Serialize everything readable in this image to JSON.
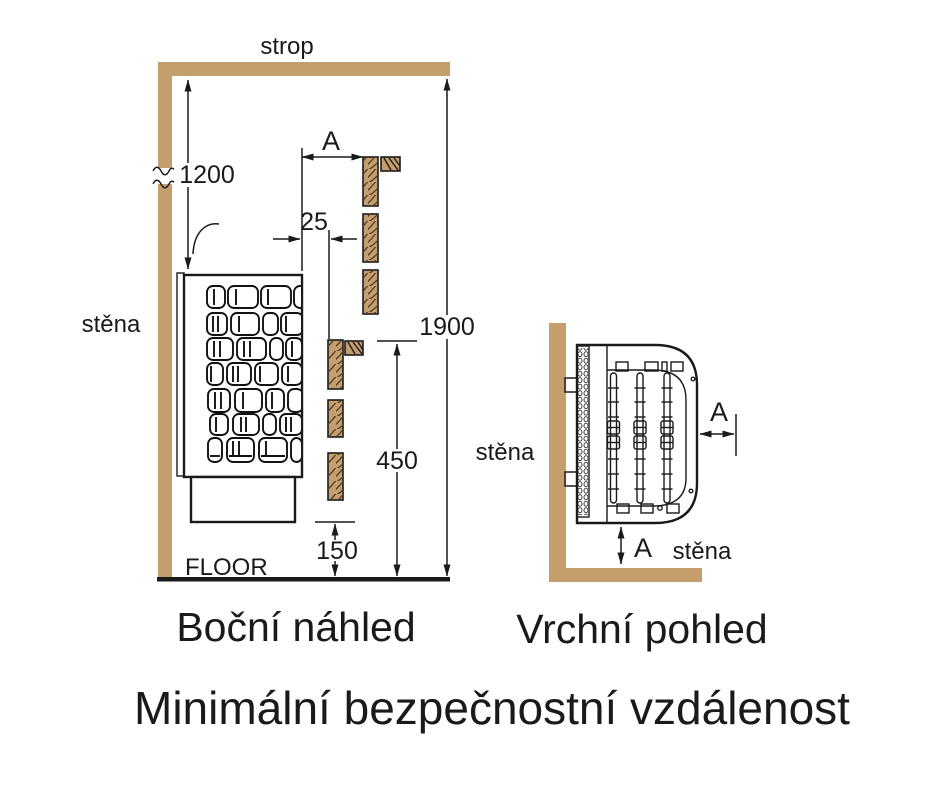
{
  "title": "Minimální bezpečnostní vzdálenost",
  "colors": {
    "wood": "#c59e6e",
    "line": "#1a1a1a",
    "background": "#ffffff"
  },
  "side_view": {
    "caption": "Boční náhled",
    "ceiling_label": "strop",
    "wall_label": "stěna",
    "floor_label": "FLOOR",
    "dim_ceiling_to_heater": "1200",
    "dim_total_height": "1900",
    "dim_guard_height": "450",
    "dim_floor_clearance": "150",
    "dim_guard_gap": "25",
    "dim_side_clearance": "A"
  },
  "top_view": {
    "caption": "Vrchní pohled",
    "wall_left_label": "stěna",
    "wall_bottom_label": "stěna",
    "dim_front_clearance": "A",
    "dim_side_clearance": "A"
  }
}
